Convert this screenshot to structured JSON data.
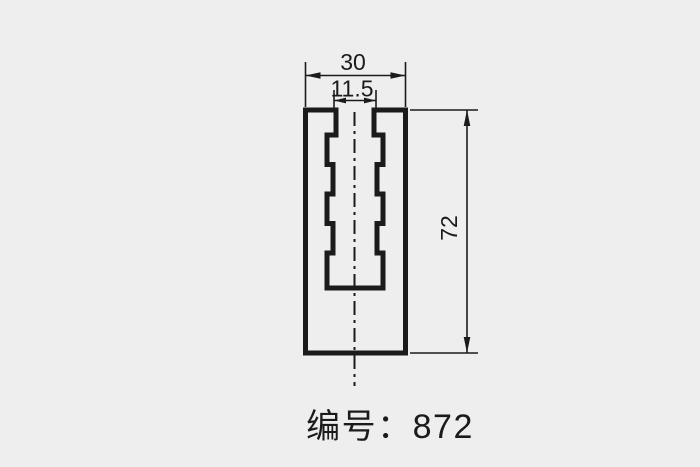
{
  "page": {
    "background_color": "#efeeef"
  },
  "drawing": {
    "line_color": "#1b1b1b",
    "type_note": "engineering cross-section profile with dimensions",
    "labels": {
      "outer_width": "30",
      "slot_width": "11.5",
      "height": "72"
    },
    "part_number": "编号：872"
  }
}
